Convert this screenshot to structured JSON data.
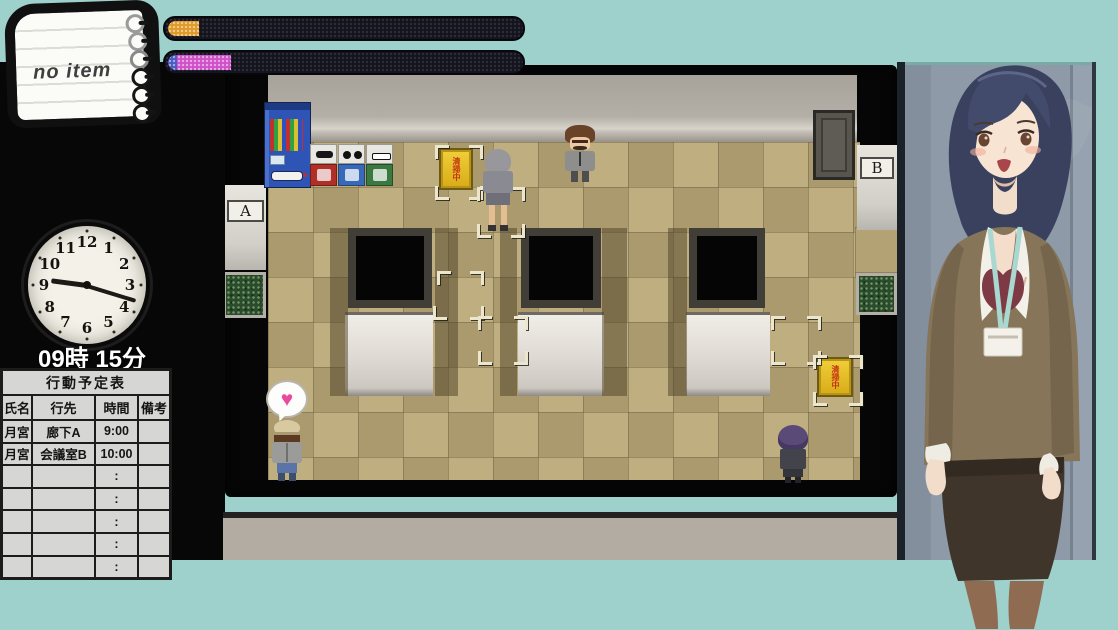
{
  "window": {
    "width": 1118,
    "height": 630
  },
  "palette": {
    "frame_teal": "#9fd1cc",
    "screen_black": "#070707",
    "floor_tan": "#b3a273",
    "wall_gray": "#b2ada4",
    "gauge_track": "#14141d",
    "gauge1_fill": "#e09a28",
    "gauge2_fill_blue": "#4a5cc4",
    "gauge2_fill_magenta": "#cf52c8",
    "heart_pink": "#e84a9c",
    "sign_yellow": "#e6c11f",
    "sign_text_red": "#c23314",
    "portrait_wall": "#8e9aa8"
  },
  "hud": {
    "notepad": {
      "text": "no item"
    },
    "gauges": [
      {
        "name": "gauge-top",
        "segments": [
          {
            "color": "#e09a28",
            "pct": 8.8
          }
        ]
      },
      {
        "name": "gauge-bottom",
        "segments": [
          {
            "color": "#4a5cc4",
            "pct": 2.5
          },
          {
            "color": "#cf52c8",
            "pct": 15.5
          }
        ]
      }
    ],
    "clock": {
      "label": "09時 15分",
      "hour_angle_deg": 277.5,
      "minute_angle_deg": 107,
      "numbers": [
        "1",
        "2",
        "3",
        "4",
        "5",
        "6",
        "7",
        "8",
        "9",
        "10",
        "11",
        "12"
      ]
    },
    "schedule": {
      "title": "行動予定表",
      "columns": [
        "氏名",
        "行先",
        "時間",
        "備考"
      ],
      "rows": [
        [
          "月宮",
          "廊下A",
          "9:00",
          ""
        ],
        [
          "月宮",
          "会議室B",
          "10:00",
          ""
        ],
        [
          "",
          "",
          ":",
          ""
        ],
        [
          "",
          "",
          ":",
          ""
        ],
        [
          "",
          "",
          ":",
          ""
        ],
        [
          "",
          "",
          ":",
          ""
        ],
        [
          "",
          "",
          ":",
          ""
        ]
      ]
    }
  },
  "map": {
    "door_labels": [
      {
        "id": "door-a",
        "text": "A"
      },
      {
        "id": "door-b",
        "text": "B"
      }
    ],
    "signs": [
      {
        "id": "cleaning-sign-top",
        "text": "清掃中"
      },
      {
        "id": "cleaning-sign-right",
        "text": "清掃中"
      }
    ],
    "emote_glyph": "♥",
    "cursor_brackets": [
      {
        "x": 210,
        "y": 80,
        "d": "tl"
      },
      {
        "x": 244,
        "y": 80,
        "d": "tr"
      },
      {
        "x": 210,
        "y": 121,
        "d": "bl"
      },
      {
        "x": 244,
        "y": 121,
        "d": "br"
      },
      {
        "x": 252,
        "y": 122,
        "d": "tl"
      },
      {
        "x": 286,
        "y": 122,
        "d": "tr"
      },
      {
        "x": 252,
        "y": 159,
        "d": "bl"
      },
      {
        "x": 286,
        "y": 159,
        "d": "br"
      },
      {
        "x": 212,
        "y": 206,
        "d": "tl"
      },
      {
        "x": 245,
        "y": 206,
        "d": "tr"
      },
      {
        "x": 208,
        "y": 241,
        "d": "bl"
      },
      {
        "x": 245,
        "y": 241,
        "d": "br"
      },
      {
        "x": 253,
        "y": 251,
        "d": "tl"
      },
      {
        "x": 289,
        "y": 251,
        "d": "tr"
      },
      {
        "x": 253,
        "y": 286,
        "d": "bl"
      },
      {
        "x": 289,
        "y": 286,
        "d": "br"
      },
      {
        "x": 546,
        "y": 251,
        "d": "tl"
      },
      {
        "x": 582,
        "y": 251,
        "d": "tr"
      },
      {
        "x": 546,
        "y": 286,
        "d": "bl"
      },
      {
        "x": 582,
        "y": 286,
        "d": "br"
      },
      {
        "x": 588,
        "y": 290,
        "d": "tl"
      },
      {
        "x": 624,
        "y": 290,
        "d": "tr"
      },
      {
        "x": 588,
        "y": 327,
        "d": "bl"
      },
      {
        "x": 624,
        "y": 327,
        "d": "br"
      }
    ]
  }
}
